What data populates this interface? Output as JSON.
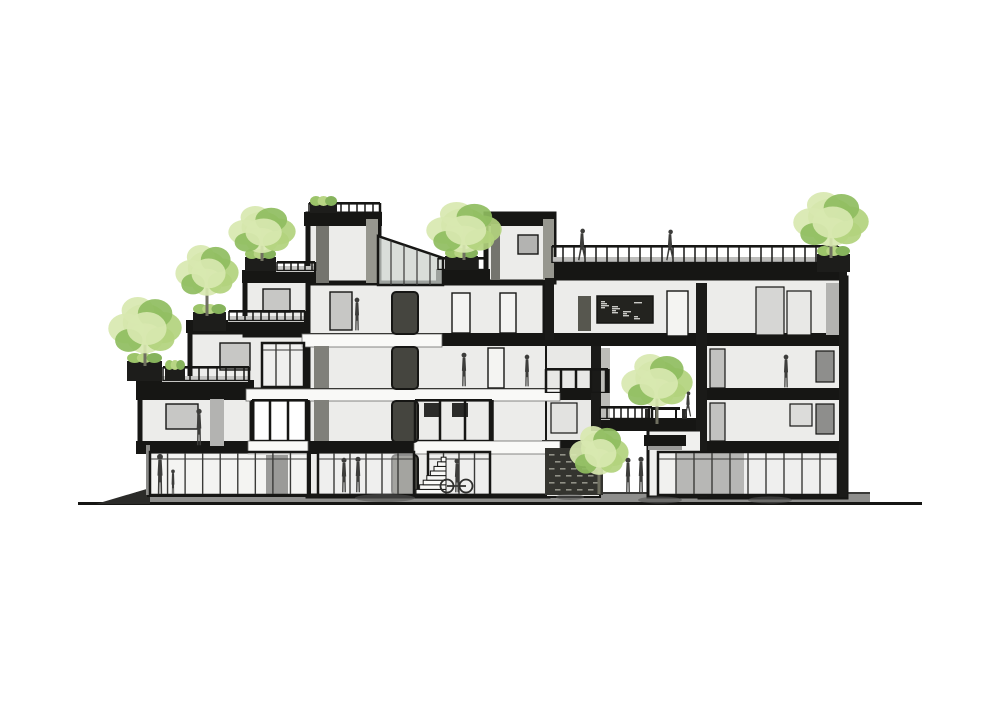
{
  "scene": {
    "width": 1000,
    "height": 707,
    "background": "#ffffff",
    "palette": {
      "ink": "#161614",
      "wall": "#ececea",
      "wallShade": "#dededc",
      "glass": "#f2f2f0",
      "mullion": "#3a3a38",
      "gray": "#9a9a98",
      "figure": "#3d3d3b",
      "band": "#8f8f8d",
      "bandEdge": "#3a3a38",
      "white": "#f9f9f7",
      "leafLight": "#d8e8b0",
      "leafMid": "#b2d37d",
      "leafDark": "#8fbd60",
      "trunk": "#6f6f60",
      "planter": "#1d1d1b",
      "slat": "#34342f",
      "slatDash": "#a9a99e",
      "boardInk": "#23231f",
      "chalk": "#e8e8e4"
    },
    "ground": {
      "baseline": {
        "x": 78,
        "y": 502,
        "w": 844,
        "h": 3
      },
      "band": {
        "x": 136,
        "y": 493,
        "w": 734,
        "h": 12
      },
      "bandTop": {
        "x": 136,
        "y": 492,
        "w": 734,
        "h": 2
      },
      "wedge": [
        [
          96,
          504
        ],
        [
          150,
          488
        ],
        [
          150,
          504
        ]
      ]
    },
    "blocks": [
      {
        "n": "block-left-cantilever",
        "x": 140,
        "y": 392,
        "w": 112,
        "h": 58
      },
      {
        "n": "block-left-step2",
        "x": 190,
        "y": 332,
        "w": 116,
        "h": 58
      },
      {
        "n": "block-left-step3",
        "x": 245,
        "y": 276,
        "w": 70,
        "h": 59
      },
      {
        "n": "block-central-tower",
        "x": 308,
        "y": 214,
        "w": 71,
        "h": 71
      },
      {
        "n": "block-mid",
        "x": 308,
        "y": 283,
        "w": 240,
        "h": 213
      },
      {
        "n": "block-ground-left",
        "x": 148,
        "y": 448,
        "w": 162,
        "h": 48,
        "f": "#f5f5f3",
        "sw": 2
      },
      {
        "n": "block-bridge",
        "x": 545,
        "y": 278,
        "w": 301,
        "h": 63
      },
      {
        "n": "block-penthouse",
        "x": 486,
        "y": 214,
        "w": 68,
        "h": 68
      },
      {
        "n": "block-leftzone",
        "x": 546,
        "y": 341,
        "w": 54,
        "h": 156,
        "f": "#e8e8e6",
        "sw": 2
      },
      {
        "n": "block-right",
        "x": 700,
        "y": 340,
        "w": 146,
        "h": 157
      },
      {
        "n": "block-void-pavilion",
        "x": 648,
        "y": 430,
        "w": 56,
        "h": 67,
        "f": "#f0f0ee",
        "sw": 3
      }
    ],
    "slabs": [
      {
        "n": "slab-tower-roof",
        "x": 304,
        "y": 212,
        "w": 78,
        "h": 14
      },
      {
        "n": "slab-penthouse-roof",
        "x": 484,
        "y": 212,
        "w": 72,
        "h": 14
      },
      {
        "n": "slab-step3-roof",
        "x": 242,
        "y": 270,
        "w": 74,
        "h": 13
      },
      {
        "n": "slab-terrace-t4",
        "x": 436,
        "y": 269,
        "w": 54,
        "h": 13
      },
      {
        "n": "slab-bridge-roof",
        "x": 545,
        "y": 262,
        "w": 302,
        "h": 17
      },
      {
        "n": "slab-step2-roof",
        "x": 186,
        "y": 320,
        "w": 122,
        "h": 13
      },
      {
        "n": "slab-step1-roof",
        "x": 136,
        "y": 380,
        "w": 118,
        "h": 14
      },
      {
        "n": "slab-level4",
        "x": 308,
        "y": 333,
        "w": 539,
        "h": 13
      },
      {
        "n": "slab-level3-left",
        "x": 136,
        "y": 388,
        "w": 461,
        "h": 12
      },
      {
        "n": "slab-level2-left",
        "x": 136,
        "y": 441,
        "w": 461,
        "h": 13
      },
      {
        "n": "slab-level3-right",
        "x": 700,
        "y": 388,
        "w": 146,
        "h": 12
      },
      {
        "n": "slab-level2-right",
        "x": 700,
        "y": 441,
        "w": 146,
        "h": 12
      },
      {
        "n": "slab-void-terrace",
        "x": 596,
        "y": 418,
        "w": 110,
        "h": 13
      },
      {
        "n": "slab-slatwall-beam",
        "x": 542,
        "y": 440,
        "w": 62,
        "h": 10
      }
    ],
    "whiteBands": [
      {
        "n": "gallery-band-l4",
        "x": 302,
        "y": 334,
        "w": 140,
        "h": 13
      },
      {
        "n": "gallery-band-l3",
        "x": 246,
        "y": 389,
        "w": 314,
        "h": 12
      },
      {
        "n": "gallery-band-l2a",
        "x": 248,
        "y": 441,
        "w": 60,
        "h": 13
      },
      {
        "n": "gallery-band-l2b",
        "x": 414,
        "y": 441,
        "w": 146,
        "h": 13
      }
    ],
    "rects": [
      {
        "n": "tower-inner-wall",
        "x": 316,
        "y": 226,
        "w": 13,
        "h": 57,
        "f": "#74746e"
      },
      {
        "n": "tower-side-face",
        "x": 366,
        "y": 219,
        "w": 12,
        "h": 64,
        "f": "#97978f"
      },
      {
        "n": "penthouse-side-face",
        "x": 543,
        "y": 219,
        "w": 11,
        "h": 61,
        "f": "#97978f"
      },
      {
        "n": "penthouse-inner-edge",
        "x": 491,
        "y": 224,
        "w": 9,
        "h": 56,
        "f": "#74746e"
      },
      {
        "n": "window-left-apartment",
        "x": 166,
        "y": 404,
        "w": 32,
        "h": 25,
        "f": "#c7c7c5",
        "s": 1.4
      },
      {
        "n": "door-left-apartment",
        "x": 210,
        "y": 399,
        "w": 14,
        "h": 47,
        "f": "#b3b3b1"
      },
      {
        "n": "window-step2",
        "x": 220,
        "y": 343,
        "w": 30,
        "h": 27,
        "f": "#c7c7c5",
        "s": 1.4
      },
      {
        "n": "window-step3",
        "x": 263,
        "y": 289,
        "w": 27,
        "h": 23,
        "f": "#c7c7c5",
        "s": 1.4
      },
      {
        "n": "window-penthouse",
        "x": 518,
        "y": 235,
        "w": 20,
        "h": 19,
        "f": "#b3b3b1",
        "s": 1.4
      },
      {
        "n": "tower-room-door",
        "x": 330,
        "y": 292,
        "w": 22,
        "h": 38,
        "f": "#c7c7c5",
        "s": 1.4
      },
      {
        "n": "doorframe-l4-a",
        "x": 452,
        "y": 293,
        "w": 18,
        "h": 40,
        "f": "#f4f4f2",
        "s": 1.4
      },
      {
        "n": "doorframe-l4-b",
        "x": 500,
        "y": 293,
        "w": 16,
        "h": 40,
        "f": "#f4f4f2",
        "s": 1.4
      },
      {
        "n": "doorframe-l3",
        "x": 488,
        "y": 348,
        "w": 16,
        "h": 40,
        "f": "#f4f4f2",
        "s": 1.4
      },
      {
        "n": "shelf-ladder",
        "x": 578,
        "y": 296,
        "w": 13,
        "h": 35,
        "f": "#57574f"
      },
      {
        "n": "doorframe-bridge",
        "x": 667,
        "y": 291,
        "w": 21,
        "h": 45,
        "f": "#f4f4f2",
        "s": 1.4
      },
      {
        "n": "closet-bridge-a",
        "x": 756,
        "y": 287,
        "w": 28,
        "h": 48,
        "f": "#d6d6d4",
        "s": 1.2
      },
      {
        "n": "closet-bridge-b",
        "x": 787,
        "y": 291,
        "w": 24,
        "h": 44,
        "f": "#e8e8e6",
        "s": 1.2
      },
      {
        "n": "bridge-right-face",
        "x": 826,
        "y": 283,
        "w": 13,
        "h": 52,
        "f": "#b3b3b1"
      },
      {
        "n": "window-right-l3",
        "x": 816,
        "y": 351,
        "w": 18,
        "h": 31,
        "f": "#8e8e8c",
        "s": 1.2
      },
      {
        "n": "window-right-l2",
        "x": 816,
        "y": 404,
        "w": 18,
        "h": 30,
        "f": "#8e8e8c",
        "s": 1.2
      },
      {
        "n": "doorframe-right-l3",
        "x": 710,
        "y": 349,
        "w": 15,
        "h": 39,
        "f": "#c2c2c0",
        "s": 1.2
      },
      {
        "n": "doorframe-right-l2",
        "x": 710,
        "y": 403,
        "w": 15,
        "h": 38,
        "f": "#c2c2c0",
        "s": 1.2
      },
      {
        "n": "window-right-l2-b",
        "x": 790,
        "y": 404,
        "w": 22,
        "h": 22,
        "f": "#dcdcda",
        "s": 1.2
      },
      {
        "n": "window-leftzone",
        "x": 551,
        "y": 403,
        "w": 26,
        "h": 30,
        "f": "#e2e2e0",
        "s": 1.2
      },
      {
        "n": "void-column-left",
        "x": 591,
        "y": 346,
        "w": 10,
        "h": 85,
        "f": "#1a1a18"
      },
      {
        "n": "void-column-right",
        "x": 696,
        "y": 283,
        "w": 10,
        "h": 148,
        "f": "#1a1a18"
      },
      {
        "n": "void-speckle-strip",
        "x": 601,
        "y": 348,
        "w": 9,
        "h": 72,
        "f": "#bcbcb8"
      },
      {
        "n": "rightblock-left-wall",
        "x": 700,
        "y": 283,
        "w": 7,
        "h": 214,
        "f": "#1a1a18"
      },
      {
        "n": "rightblock-right-wall",
        "x": 839,
        "y": 262,
        "w": 8,
        "h": 235,
        "f": "#1a1a18"
      },
      {
        "n": "bridge-left-column",
        "x": 545,
        "y": 278,
        "w": 9,
        "h": 62,
        "f": "#1a1a18"
      },
      {
        "n": "roof-deck",
        "x": 552,
        "y": 257,
        "w": 268,
        "h": 6,
        "f": "#bdbdbb"
      },
      {
        "n": "deck-step1",
        "x": 162,
        "y": 376,
        "w": 86,
        "h": 6,
        "f": "#c6c6c4"
      },
      {
        "n": "deck-step2",
        "x": 228,
        "y": 316,
        "w": 76,
        "h": 6,
        "f": "#c6c6c4"
      },
      {
        "n": "deck-step3",
        "x": 276,
        "y": 266,
        "w": 38,
        "h": 6,
        "f": "#c6c6c4"
      },
      {
        "n": "core-wall-strip-l3",
        "x": 314,
        "y": 346,
        "w": 15,
        "h": 42,
        "f": "#80807a"
      },
      {
        "n": "core-wall-strip-l2",
        "x": 314,
        "y": 400,
        "w": 15,
        "h": 41,
        "f": "#80807a"
      },
      {
        "n": "balcony-equipment-a",
        "x": 424,
        "y": 403,
        "w": 16,
        "h": 14,
        "f": "#2b2b29"
      },
      {
        "n": "balcony-equipment-b",
        "x": 452,
        "y": 403,
        "w": 16,
        "h": 14,
        "f": "#2b2b29"
      },
      {
        "n": "door-storefront-left",
        "x": 266,
        "y": 455,
        "w": 22,
        "h": 39,
        "f": "#30302e"
      },
      {
        "n": "interior-dark-right",
        "x": 676,
        "y": 453,
        "w": 68,
        "h": 42,
        "f": "#6f6f6d"
      },
      {
        "n": "ground-left-edge",
        "x": 146,
        "y": 445,
        "w": 4,
        "h": 50,
        "f": "#8a8a88"
      },
      {
        "n": "pavilion-canopy",
        "x": 644,
        "y": 435,
        "w": 42,
        "h": 11,
        "f": "#161614"
      },
      {
        "n": "pavilion-canopy-under",
        "x": 648,
        "y": 446,
        "w": 34,
        "h": 4,
        "f": "#9a9a98"
      },
      {
        "n": "core-door-l4",
        "x": 392,
        "y": 292,
        "w": 26,
        "h": 42,
        "f": "#45453f",
        "s": 2,
        "rx": 4
      },
      {
        "n": "core-door-l3",
        "x": 392,
        "y": 347,
        "w": 26,
        "h": 42,
        "f": "#45453f",
        "s": 2,
        "rx": 4
      },
      {
        "n": "core-door-l2",
        "x": 392,
        "y": 401,
        "w": 26,
        "h": 41,
        "f": "#45453f",
        "s": 2,
        "rx": 4
      },
      {
        "n": "core-door-l1",
        "x": 392,
        "y": 455,
        "w": 26,
        "h": 40,
        "f": "#45453f",
        "s": 2,
        "rx": 4
      }
    ],
    "glass": [
      {
        "n": "storefront-left",
        "x": 150,
        "y": 452,
        "w": 158,
        "h": 43,
        "m": 8
      },
      {
        "n": "storefront-mid",
        "x": 318,
        "y": 452,
        "w": 96,
        "h": 43,
        "m": 5
      },
      {
        "n": "storefront-core",
        "x": 428,
        "y": 452,
        "w": 62,
        "h": 43,
        "m": 3
      },
      {
        "n": "storefront-right",
        "x": 658,
        "y": 452,
        "w": 180,
        "h": 43,
        "m": 9
      },
      {
        "n": "window-wall-l3-left",
        "x": 262,
        "y": 343,
        "w": 42,
        "h": 44,
        "m": 2
      }
    ],
    "canopy": {
      "pts": [
        [
          378,
          236
        ],
        [
          443,
          258
        ],
        [
          443,
          285
        ],
        [
          378,
          285
        ]
      ],
      "mullions": 4
    },
    "railings": [
      {
        "n": "railing-tower-roof",
        "x1": 309,
        "x2": 380,
        "y": 202,
        "h": 12,
        "g": 8
      },
      {
        "n": "railing-step3-terrace",
        "x1": 277,
        "x2": 315,
        "y": 261,
        "h": 10,
        "g": 7
      },
      {
        "n": "railing-step2-terrace",
        "x1": 229,
        "x2": 305,
        "y": 310,
        "h": 11,
        "g": 8
      },
      {
        "n": "railing-step1-terrace",
        "x1": 163,
        "x2": 249,
        "y": 366,
        "h": 15,
        "g": 9
      },
      {
        "n": "railing-roof-terrace",
        "x1": 552,
        "x2": 838,
        "y": 245,
        "h": 18,
        "g": 11
      },
      {
        "n": "railing-penthouse-terrace",
        "x1": 438,
        "x2": 487,
        "y": 257,
        "h": 13,
        "g": 8
      },
      {
        "n": "railing-void-terrace",
        "x1": 600,
        "x2": 652,
        "y": 406,
        "h": 13,
        "g": 7
      },
      {
        "n": "railing-balcony-mid",
        "x1": 415,
        "x2": 492,
        "y": 399,
        "h": 42,
        "g": 25,
        "pw": 2.5
      },
      {
        "n": "railing-leftzone-balcony",
        "x1": 546,
        "x2": 608,
        "y": 368,
        "h": 25,
        "g": 15,
        "pw": 2.5
      },
      {
        "n": "railing-l2-left",
        "x1": 252,
        "x2": 308,
        "y": 399,
        "h": 42,
        "g": 18,
        "pw": 2.5
      }
    ],
    "planters": [
      {
        "n": "planter-tree-1",
        "x": 127,
        "y": 361,
        "w": 35,
        "h": 20
      },
      {
        "n": "planter-small-1",
        "x": 165,
        "y": 368,
        "w": 20,
        "h": 13
      },
      {
        "n": "planter-tree-2",
        "x": 193,
        "y": 312,
        "w": 33,
        "h": 19
      },
      {
        "n": "planter-tree-3",
        "x": 245,
        "y": 257,
        "w": 31,
        "h": 14
      },
      {
        "n": "planter-tree-4",
        "x": 445,
        "y": 256,
        "w": 33,
        "h": 14
      },
      {
        "n": "planter-tree-5",
        "x": 817,
        "y": 254,
        "w": 33,
        "h": 18
      },
      {
        "n": "planter-tower-roof",
        "x": 310,
        "y": 204,
        "w": 27,
        "h": 9
      }
    ],
    "trees": [
      {
        "n": "tree-terrace-1",
        "cx": 145,
        "cy": 327,
        "rx": 36,
        "ry": 30,
        "base": 366
      },
      {
        "n": "tree-terrace-2",
        "cx": 207,
        "cy": 272,
        "rx": 31,
        "ry": 27,
        "base": 316
      },
      {
        "n": "tree-terrace-3",
        "cx": 262,
        "cy": 231,
        "rx": 33,
        "ry": 25,
        "base": 261
      },
      {
        "n": "tree-terrace-4",
        "cx": 464,
        "cy": 229,
        "rx": 37,
        "ry": 27,
        "base": 260
      },
      {
        "n": "tree-roof-right",
        "cx": 831,
        "cy": 221,
        "rx": 37,
        "ry": 29,
        "base": 258
      },
      {
        "n": "tree-void-courtyard",
        "cx": 657,
        "cy": 382,
        "rx": 35,
        "ry": 28,
        "base": 424
      },
      {
        "n": "tree-ground",
        "cx": 599,
        "cy": 452,
        "rx": 29,
        "ry": 26,
        "base": 494
      }
    ],
    "slatWall": {
      "x": 545,
      "y": 448,
      "w": 58,
      "h": 47,
      "rows": 6
    },
    "chalkboard": {
      "x": 597,
      "y": 296,
      "w": 56,
      "h": 27,
      "dashes": 14
    },
    "stairs": {
      "x": 416,
      "y": 494,
      "w": 30,
      "stepH": 4.6,
      "steps": 8
    },
    "table": {
      "x": 652,
      "y": 407,
      "w": 28,
      "legH": 11
    },
    "mats": [
      {
        "cx": 385,
        "cy": 498,
        "rx": 30,
        "ry": 4
      },
      {
        "cx": 570,
        "cy": 497,
        "rx": 14,
        "ry": 3
      },
      {
        "cx": 660,
        "cy": 500,
        "rx": 22,
        "ry": 3.5
      },
      {
        "cx": 770,
        "cy": 500,
        "rx": 22,
        "ry": 3.5
      }
    ],
    "figures": [
      {
        "n": "figure-left-apartment",
        "x": 199,
        "feet": 446,
        "h": 38,
        "pose": "stand"
      },
      {
        "n": "figure-tower-room",
        "x": 357,
        "feet": 331,
        "h": 34,
        "pose": "stand"
      },
      {
        "n": "figure-l3-man",
        "x": 464,
        "feet": 387,
        "h": 35,
        "pose": "stand"
      },
      {
        "n": "figure-l3-woman",
        "x": 527,
        "feet": 387,
        "h": 33,
        "pose": "stand"
      },
      {
        "n": "figure-rightblock-woman",
        "x": 786,
        "feet": 388,
        "h": 34,
        "pose": "stand"
      },
      {
        "n": "figure-roof-walker-1",
        "x": 582,
        "feet": 261,
        "h": 33,
        "pose": "walk"
      },
      {
        "n": "figure-roof-walker-2",
        "x": 670,
        "feet": 261,
        "h": 32,
        "pose": "walk"
      },
      {
        "n": "figure-void-terrace",
        "x": 688,
        "feet": 417,
        "h": 26,
        "pose": "walk"
      },
      {
        "n": "figure-ground-adult",
        "x": 160,
        "feet": 495,
        "h": 42,
        "pose": "stand"
      },
      {
        "n": "figure-ground-child",
        "x": 173,
        "feet": 495,
        "h": 26,
        "pose": "child"
      },
      {
        "n": "figure-ground-pair-a",
        "x": 344,
        "feet": 493,
        "h": 36,
        "pose": "stand"
      },
      {
        "n": "figure-ground-pair-b",
        "x": 358,
        "feet": 493,
        "h": 37,
        "pose": "stand"
      },
      {
        "n": "figure-ground-bike",
        "x": 457,
        "feet": 493,
        "h": 35,
        "pose": "stand",
        "bike": true
      },
      {
        "n": "figure-ground-pair-c",
        "x": 628,
        "feet": 493,
        "h": 36,
        "pose": "stand"
      },
      {
        "n": "figure-ground-pair-d",
        "x": 641,
        "feet": 493,
        "h": 37,
        "pose": "stand"
      }
    ]
  }
}
